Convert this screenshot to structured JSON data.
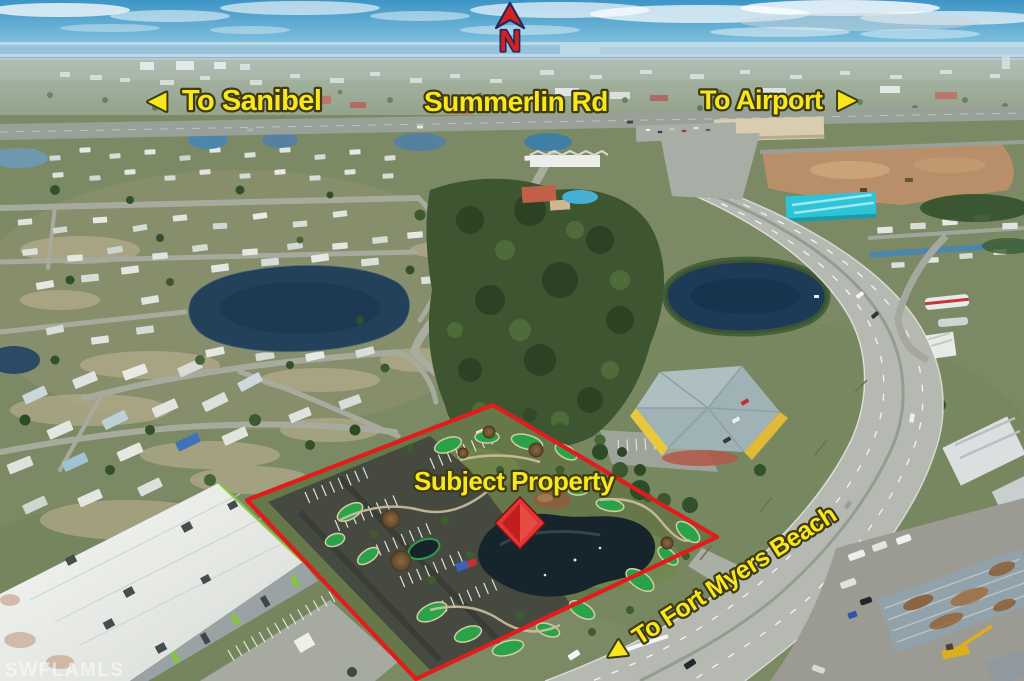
{
  "annotations": {
    "north": {
      "letter": "N"
    },
    "to_sanibel": {
      "arrow": "◀",
      "label": "To Sanibel"
    },
    "summerlin_rd": {
      "label": "Summerlin Rd"
    },
    "to_airport": {
      "label": "To Airport",
      "arrow": "▶"
    },
    "subject_property": {
      "label": "Subject Property"
    },
    "to_fort_myers_beach": {
      "arrow": "◀",
      "label": "To Fort Myers Beach"
    },
    "watermark": "SWFLAMLS"
  },
  "colors": {
    "annotation_yellow": "#F8E71C",
    "annotation_outline": "#3E3A14",
    "north_arrow_red": "#D52020",
    "north_arrow_outline": "#27275A",
    "property_boundary_red": "#E01D1D",
    "property_marker_red": "#E23535"
  }
}
